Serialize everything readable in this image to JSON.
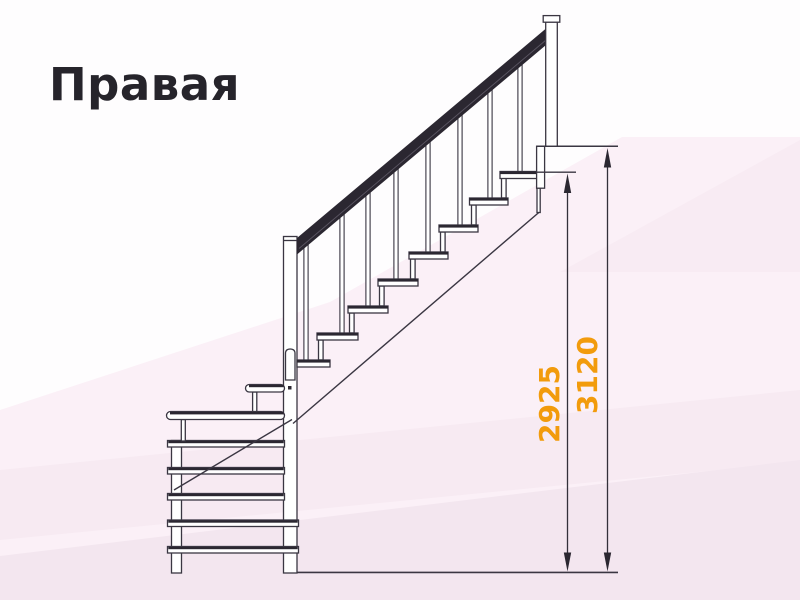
{
  "title": "Правая",
  "diagram": {
    "dimensions": [
      {
        "label": "2925"
      },
      {
        "label": "3120"
      }
    ],
    "colors": {
      "dimension_text": "#F29B0C",
      "outline": "#3A3642",
      "handrail": "#2B2731",
      "background_tint": "#FBF0F7"
    }
  }
}
